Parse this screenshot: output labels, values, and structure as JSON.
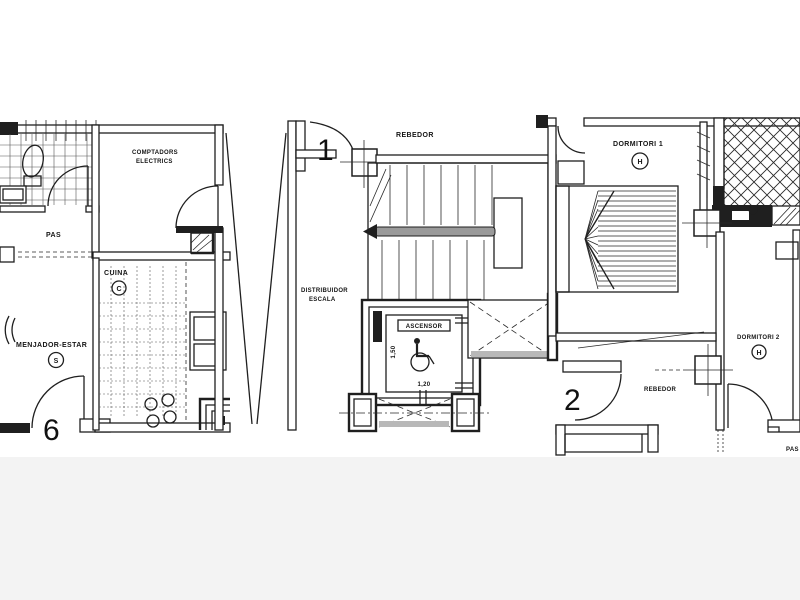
{
  "colors": {
    "ink": "#1f1f1f",
    "paper": "#ffffff",
    "handrail_gray": "#9a9a9a",
    "shade_gray": "#b8b8b8",
    "footer_gray": "#f3f3f3"
  },
  "unit_left": {
    "meters_line1": "COMPTADORS",
    "meters_line2": "ELECTRICS",
    "pas": "PAS",
    "kitchen_label": "CUINA",
    "kitchen_code": "C",
    "living_label": "MENJADOR-ESTAR",
    "living_code": "S",
    "door_number": "6"
  },
  "core": {
    "door_number": "1",
    "hall": "REBEDOR",
    "landing_line1": "DISTRIBUIDOR",
    "landing_line2": "ESCALA",
    "elevator_label": "ASCENSOR",
    "elevator_width": "1,20",
    "elevator_depth": "1,50"
  },
  "unit_right": {
    "bedroom1_label": "DORMITORI 1",
    "bedroom1_code": "H",
    "bedroom2_label": "DORMITORI 2",
    "bedroom2_code": "H",
    "hall": "REBEDOR",
    "door_number": "2",
    "pas": "PAS"
  }
}
